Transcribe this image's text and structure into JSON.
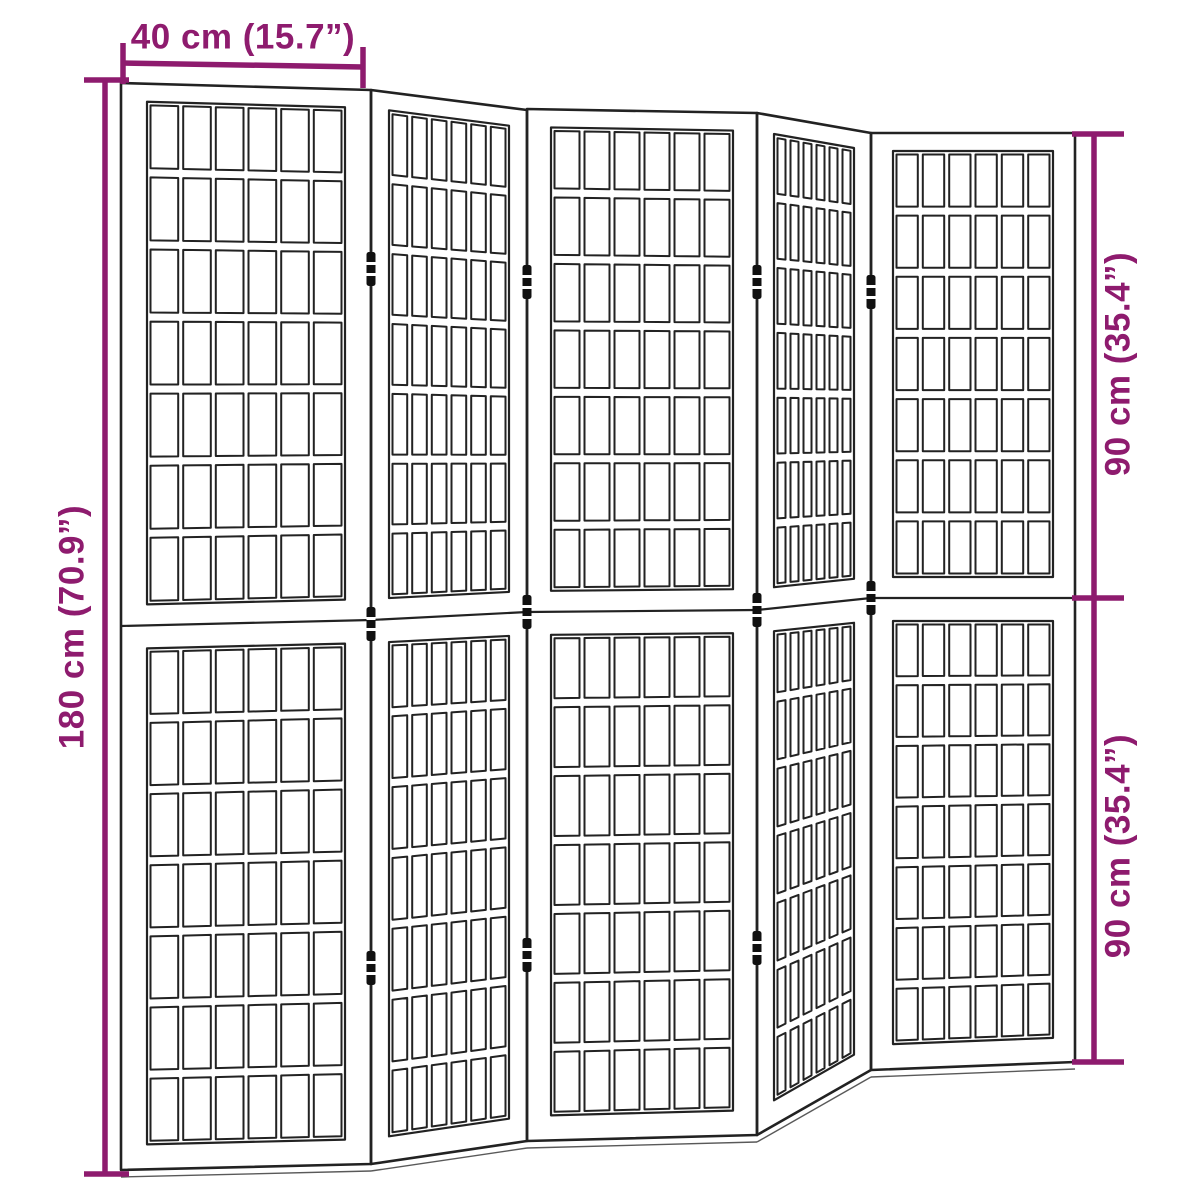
{
  "colors": {
    "dimension": "#8e1b6e",
    "line": "#222222",
    "hinge": "#111111",
    "background": "#ffffff"
  },
  "dimensions": {
    "width": {
      "label": "40 cm (15.7”)"
    },
    "height": {
      "label": "180 cm (70.9”)"
    },
    "panel_upper": {
      "label": "90 cm (35.4”)"
    },
    "panel_lower": {
      "label": "90 cm (35.4”)"
    }
  },
  "divider": {
    "panel_count": 5,
    "sections_per_panel": 2,
    "grid": {
      "cols": 6,
      "rows": 7
    }
  }
}
